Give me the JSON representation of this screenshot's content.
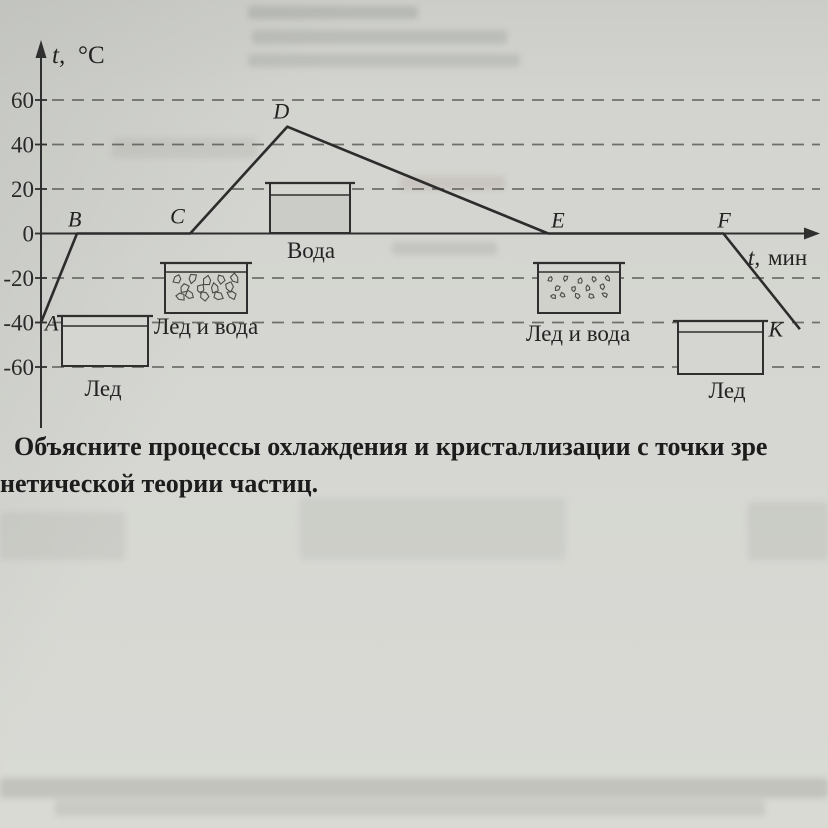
{
  "page": {
    "task": {
      "line1": "Объясните процессы охлаждения и кристаллизации с точки зре",
      "line2": "нетической теории частиц."
    }
  },
  "chart_data": {
    "type": "line",
    "title": "",
    "xlabel": "t, мин",
    "ylabel": "t, °C",
    "ylim": [
      -60,
      60
    ],
    "yticks": [
      60,
      40,
      20,
      0,
      -20,
      -40,
      -60
    ],
    "x_ticks_labeled": false,
    "grid": "dashed horizontal gridlines at every 20 °C",
    "legend_position": "none",
    "points": [
      {
        "name": "A",
        "x_rel": 0.0,
        "temp_c": -40
      },
      {
        "name": "B",
        "x_rel": 0.047,
        "temp_c": 0
      },
      {
        "name": "C",
        "x_rel": 0.195,
        "temp_c": 0
      },
      {
        "name": "D",
        "x_rel": 0.322,
        "temp_c": 48
      },
      {
        "name": "E",
        "x_rel": 0.663,
        "temp_c": 0
      },
      {
        "name": "F",
        "x_rel": 0.892,
        "temp_c": 0
      },
      {
        "name": "K",
        "x_rel": 0.985,
        "temp_c": -40
      },
      {
        "name": "",
        "x_rel": 0.992,
        "temp_c": -43
      }
    ],
    "axis": {
      "y_symbol": "t,",
      "y_unit": "°C",
      "x_symbol": "t,",
      "x_unit": "мин"
    },
    "segments_meaning": [
      "A-B нагрев льда",
      "B-C лед и вода при 0",
      "C-D нагрев воды",
      "D-E охлаждение воды",
      "E-F кристаллизация при 0",
      "F-K охлаждение льда"
    ]
  },
  "containers": [
    {
      "label": "Лед",
      "contents": "ice"
    },
    {
      "label": "Лед и вода",
      "contents": "ice-water"
    },
    {
      "label": "Вода",
      "contents": "water"
    },
    {
      "label": "Лед и вода",
      "contents": "ice-water"
    },
    {
      "label": "Лед",
      "contents": "ice"
    }
  ]
}
